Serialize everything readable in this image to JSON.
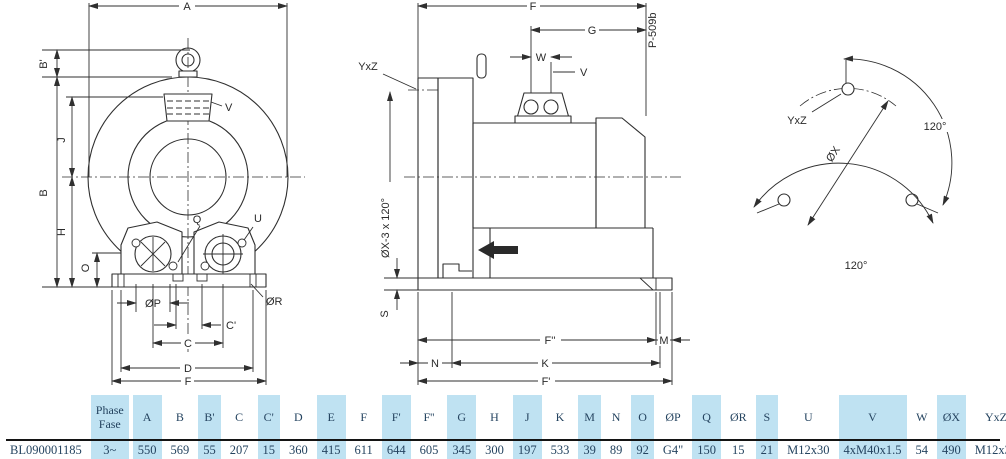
{
  "drawing": {
    "front_view": {
      "dims": {
        "A": "A",
        "B_prime": "B'",
        "B": "B",
        "J": "J",
        "H": "H",
        "O": "O",
        "V": "V",
        "Q": "Q",
        "U": "U",
        "OP": "ØP",
        "OR": "ØR",
        "C_prime": "C'",
        "C": "C",
        "D": "D",
        "F": "F"
      }
    },
    "side_view": {
      "code": "P-509b",
      "dims": {
        "F": "F",
        "G": "G",
        "W": "W",
        "V": "V",
        "YxZ": "YxZ",
        "OX3": "ØX-3 x 120°",
        "S": "S",
        "N": "N",
        "K": "K",
        "F_prime": "F'",
        "F_dprime": "F''",
        "M": "M"
      }
    },
    "flange_view": {
      "dims": {
        "YxZ": "YxZ",
        "OX": "ØX",
        "angle1": "120°",
        "angle2": "120°"
      }
    }
  },
  "table": {
    "model": "BL090001185",
    "columns": [
      {
        "h": [
          "Phase",
          "Fase"
        ],
        "v": "3~",
        "band": true
      },
      {
        "h": [
          "A"
        ],
        "v": "550",
        "band": true
      },
      {
        "h": [
          "B"
        ],
        "v": "569",
        "band": false
      },
      {
        "h": [
          "B'"
        ],
        "v": "55",
        "band": true
      },
      {
        "h": [
          "C"
        ],
        "v": "207",
        "band": false
      },
      {
        "h": [
          "C'"
        ],
        "v": "15",
        "band": true
      },
      {
        "h": [
          "D"
        ],
        "v": "360",
        "band": false
      },
      {
        "h": [
          "E"
        ],
        "v": "415",
        "band": true
      },
      {
        "h": [
          "F"
        ],
        "v": "611",
        "band": false
      },
      {
        "h": [
          "F'"
        ],
        "v": "644",
        "band": true
      },
      {
        "h": [
          "F''"
        ],
        "v": "605",
        "band": false
      },
      {
        "h": [
          "G"
        ],
        "v": "345",
        "band": true
      },
      {
        "h": [
          "H"
        ],
        "v": "300",
        "band": false
      },
      {
        "h": [
          "J"
        ],
        "v": "197",
        "band": true
      },
      {
        "h": [
          "K"
        ],
        "v": "533",
        "band": false
      },
      {
        "h": [
          "M"
        ],
        "v": "39",
        "band": true
      },
      {
        "h": [
          "N"
        ],
        "v": "89",
        "band": false
      },
      {
        "h": [
          "O"
        ],
        "v": "92",
        "band": true
      },
      {
        "h": [
          "ØP"
        ],
        "v": "G4\"",
        "band": false
      },
      {
        "h": [
          "Q"
        ],
        "v": "150",
        "band": true
      },
      {
        "h": [
          "ØR"
        ],
        "v": "15",
        "band": false
      },
      {
        "h": [
          "S"
        ],
        "v": "21",
        "band": true
      },
      {
        "h": [
          "U"
        ],
        "v": "M12x30",
        "band": false
      },
      {
        "h": [
          "V"
        ],
        "v": "4xM40x1.5",
        "band": true
      },
      {
        "h": [
          "W"
        ],
        "v": "54",
        "band": false
      },
      {
        "h": [
          "ØX"
        ],
        "v": "490",
        "band": true
      },
      {
        "h": [
          "YxZ"
        ],
        "v": "M12x30",
        "band": false
      },
      {
        "h": [
          "X-holes",
          "X-fori"
        ],
        "v": "0°/120°/240°",
        "band": true
      }
    ]
  }
}
